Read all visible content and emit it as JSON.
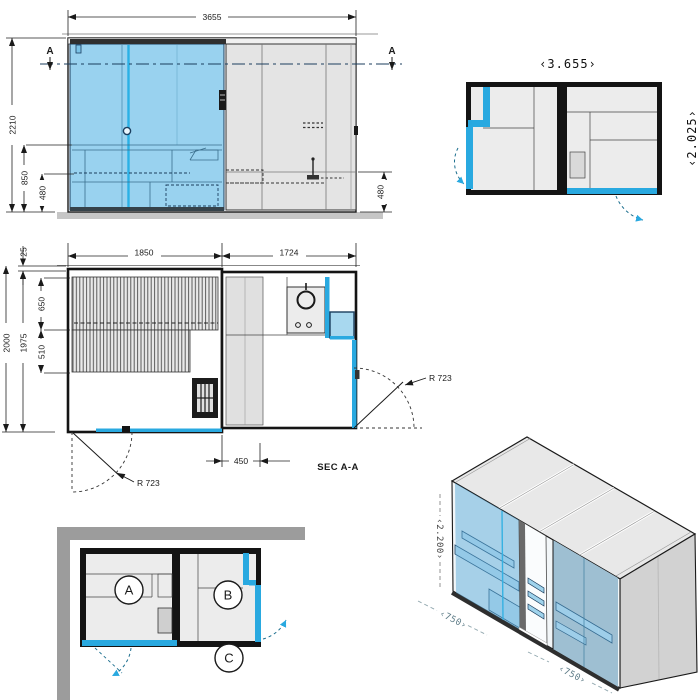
{
  "colors": {
    "accent_blue": "#29a9e0",
    "glass_fill": "#99d2ef",
    "glass_dark_line": "#1b3e5e",
    "panel_gray": "#e4e4e4",
    "panel_gray_dark": "#d2d2d2",
    "floor_gray": "#c6c6c6",
    "wall_black": "#141414",
    "band_gray": "#9c9c9c"
  },
  "front_elevation": {
    "width": "3655",
    "height": "2210",
    "bench_height": "850",
    "seat_height_left": "480",
    "seat_height_right": "480",
    "section_marker": "A"
  },
  "top_plan": {
    "width": "‹3.655›",
    "depth": "‹2.025›"
  },
  "section_plan": {
    "title": "SEC A-A",
    "sauna_width": "1850",
    "bath_width": "1724",
    "wall_offset": "25",
    "depth_outer": "2000",
    "depth_inner": "1975",
    "bench_depth_upper": "650",
    "bench_depth_lower": "510",
    "door_offset": "450",
    "door_radius_left": "R 723",
    "door_radius_right": "R 723"
  },
  "door_schematic": {
    "room_a": "A",
    "room_b": "B",
    "door_c": "C"
  },
  "isometric_view": {
    "height": "‹2.200›",
    "module_depth": "‹750›",
    "module_width": "‹750›"
  }
}
